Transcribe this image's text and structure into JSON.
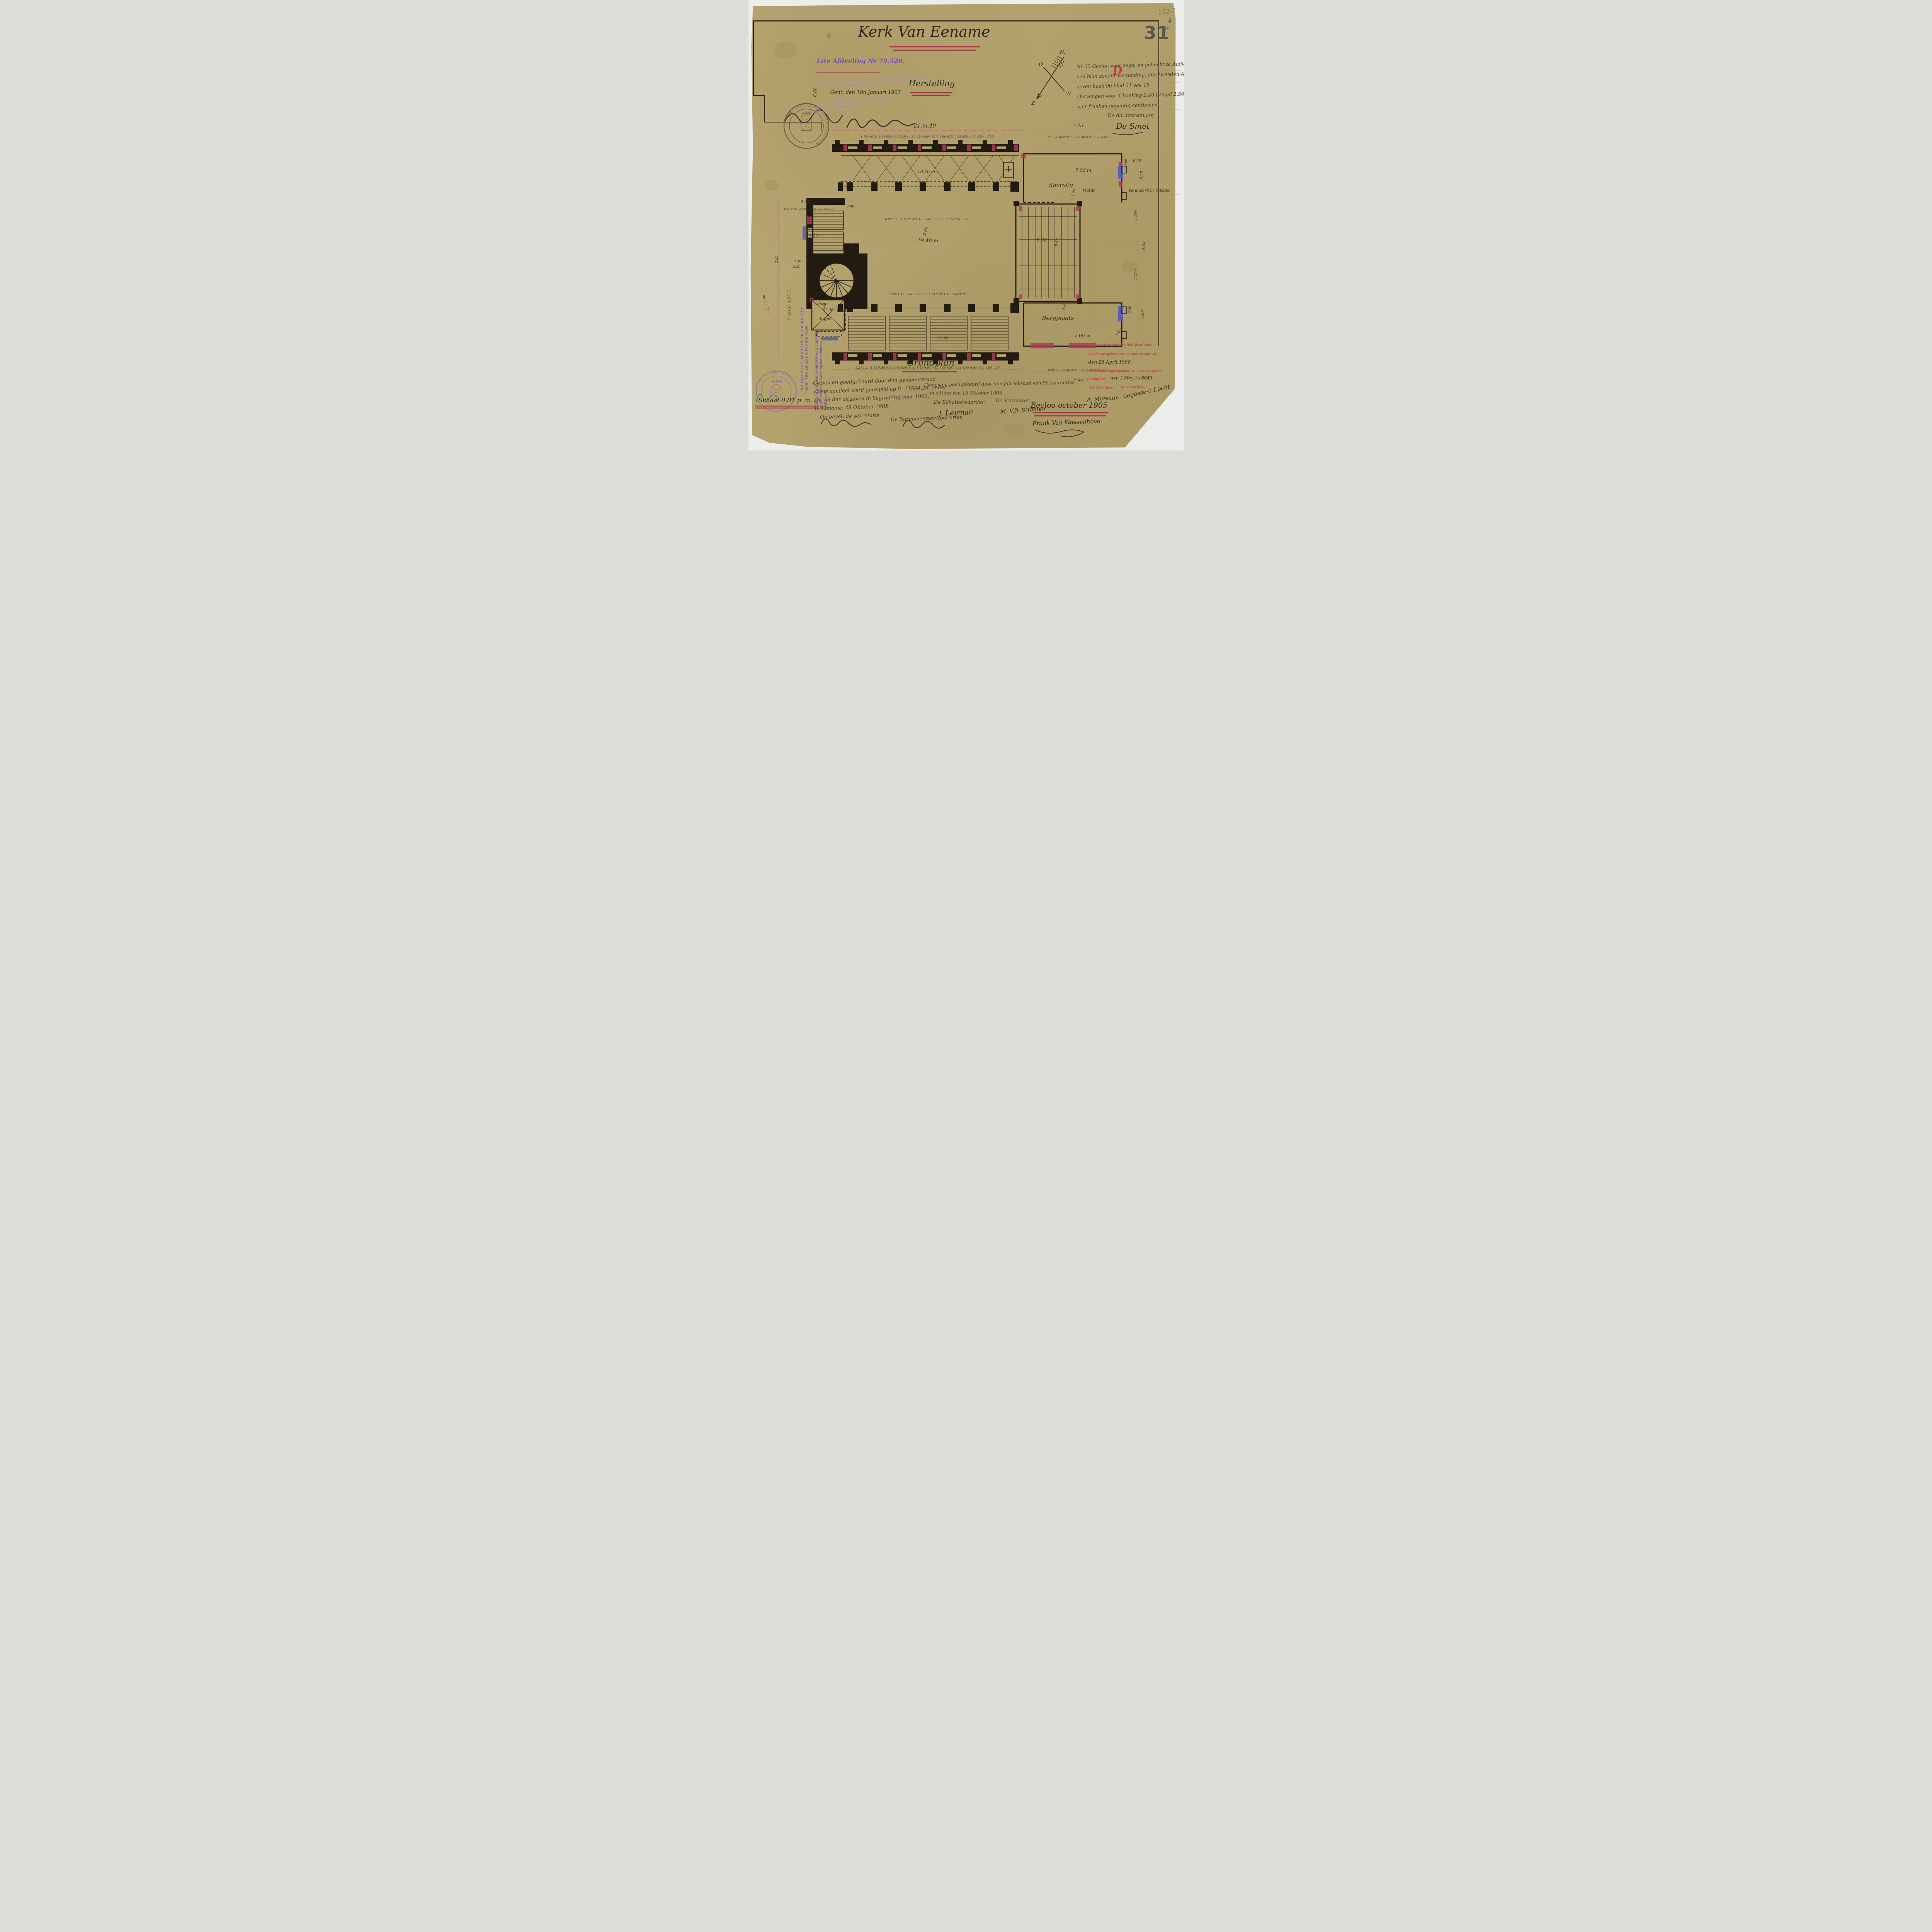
{
  "corner": {
    "pencil_line1": "152-7",
    "pencil_line2": "4",
    "pencil_line3": "m",
    "sheet_number": "31",
    "red_mark": "D"
  },
  "title": {
    "main": "Kerk Van Eename",
    "subtitle": "Herstelling"
  },
  "deputation_stamp": {
    "ref": "1ste Afdeeling Nr 79.520.",
    "l2": "Gezien en goedgekeurd door de Bestendige Deputatie",
    "l3": "van den Provincieraad",
    "l4": "Gent, den 18n Januari 1907",
    "l5": "De Gouverneur-Voorzitter",
    "l6": "Van wege de Deputatie:",
    "l7": "De Griffier der Provincie,"
  },
  "registration_note": {
    "lines": [
      "Nr 55 Gezien voor zegel en geboekt te Audenaarde",
      "een blad zonder verzending, den tweeden April 1906",
      "zeven boek 96 blad 31 vak 15",
      "Ontvangen voor { boeking 2.40 | zegel 2.50 } 4.90 Samen",
      "vier franken negentig centiemen"
    ],
    "receiver_label": "De dd. Ontvanger,",
    "receiver_sig": "De Smet"
  },
  "compass": {
    "north": "N.",
    "east": "O",
    "west": "W.",
    "south": "Z"
  },
  "dims": {
    "top_total": "21.m.40",
    "top_right_total": "7.45",
    "top_chain": "1.76½  62½  1.60  62½  0.88  62½  1.60  62½  0.94  62½  1.60  62½  0.92  62½  1.60  62½  1.76½",
    "right_top_chain": "0.88  0.90  0.88  0.85  0.88  0.90  0.88  0.85",
    "nave_upper_chain": "0.90  2.60  1.15  2.56  1.15  2.60  1.15  2.60  1.15  2.64  0.90",
    "nave_lower_chain": "2.60  1.19  2.60  1.14  2.60  1.19  2.60  1.19  2.60  0.90",
    "bottom_chain": "1.25  1.20  1.55  0.86  0.60  1.60  0.95  0.62  1.60  0.93  0.62  1.60  0.94  0.61  1.60  0.93  0.60  1.60  1.70",
    "bottom_right_chain": "0.88  0.90  0.88  0.85  0.88  0.90  0.88  0.65",
    "bottom_right_total": "7.45",
    "left_top": "5.80",
    "left_chain": "0.55 0.50 0.55 0.70 0.55 0.50 0.55 35",
    "left_door": "0.90",
    "left_height": "6.60",
    "left_v1": "2.35",
    "left_v2": "6.90",
    "left_v3": "2.50",
    "left_v4": "2.80",
    "chapel_top": "2.30",
    "chapel_out": "2.80",
    "nave_length": "19.40 m",
    "nave_width": "9.80",
    "aisle_length": "19.40 m",
    "pew_length": "19.40",
    "pew_width": "4.80 m",
    "pass1": "1.00",
    "pass2": "1.00",
    "right_a": "5.25",
    "right_b": "3.32½",
    "right_c": "8.65",
    "right_d": "3.27½",
    "right_e": "5.25",
    "right_f": "2.00",
    "right_g": "1.62½",
    "right_h": "0.90",
    "right_i": "4.00"
  },
  "rooms": {
    "sacristy": "Sacristy",
    "sacristy_w": "7.00 m",
    "sacristy_h": "4.60",
    "storage": "Bergplaats",
    "storage_w": "7.00 m",
    "storage_h": "4.60",
    "choir_w": "6.70",
    "choir_h": "6.69",
    "chapel_line1": "doop",
    "chapel_line2": "Kapel",
    "chapel_w": "2.30",
    "chapel_h": "3.00"
  },
  "window_note": {
    "a": "Wordt",
    "b": "Veranderd in Venster"
  },
  "caption": "Grondplan",
  "council_note": {
    "lines": [
      "Gezien en goedgekeurd door den gemeenteraad",
      "wiens aandeel werd geregeld op fr. 11504.26, onder",
      "art. 58 der uitgaven in begrooting voor 1906.",
      "Te Eename, 28 Oktober 1905."
    ],
    "secretary_label": "Op bevel: de sekretaris,",
    "mayor_label": "De Burgemeester-Voorzitter,"
  },
  "board_note": {
    "l1": "Gezien en goedgekeurd door den fabriekraad van St Laurentius",
    "l2": "in zitting van 15 Oktober 1905",
    "treasurer_label": "De Schatbewaarder",
    "chairman_label": "De Voorzitter",
    "treasurer_sig": "J. Leyman",
    "chairman_sig": "M. V.D. Straeten"
  },
  "royal_commission": {
    "l1": "Gezien door den Koninklijken Raad",
    "l2": "voor Kunstgebouwen in zijne zitting van",
    "date1": "den 28 April 1906.",
    "l3": "voorbehoudingen gedaan en vermeld in het",
    "l4": "verslag van",
    "date2": "den 2 Mey 1o 8649.",
    "writer_label": "De Schrijver,",
    "chairman_label": "De Voorzitter.",
    "writer_sig": "A. Massaux",
    "chairman_sig": "Lagasse-d.Locht"
  },
  "scale_note": "Schaal 0.01 p. m.",
  "place_date": "Eecloo october 1905",
  "architect_signature": "Frank Van Wassenhove",
  "justice_stamp_fr": {
    "l1": "VU PAR NOUS, MINISTRE DE LA JUSTICE",
    "l2": "pour être annexé à l'arrêté royal",
    "date": "7 août 1907."
  },
  "justice_stamp_nl": {
    "l1": "GEZIEN DOOR ONS, MINISTER VAN JUSTITIE",
    "l2": "om gevoegd te worden bij het koninklijk",
    "l3": "besluit van"
  },
  "province_stamp": "PROVINCIE OOST-VLAANDEREN",
  "justice_round_stamp": "MINISTERE DE LA JUSTICE"
}
